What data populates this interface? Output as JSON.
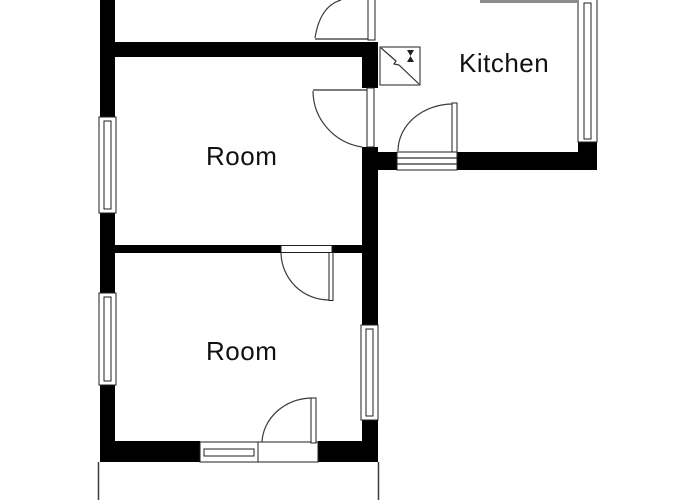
{
  "plan": {
    "type": "floor-plan",
    "rooms": [
      {
        "label": "Kitchen"
      },
      {
        "label": "Room"
      },
      {
        "label": "Room"
      }
    ],
    "features": {
      "windows": 5,
      "doors": 5,
      "fixture": "sink-unit"
    },
    "colors": {
      "wall": "#000000",
      "line": "#2e2e2e",
      "background": "#ffffff",
      "cropped_wall_gray": "#8c8c8c"
    }
  }
}
